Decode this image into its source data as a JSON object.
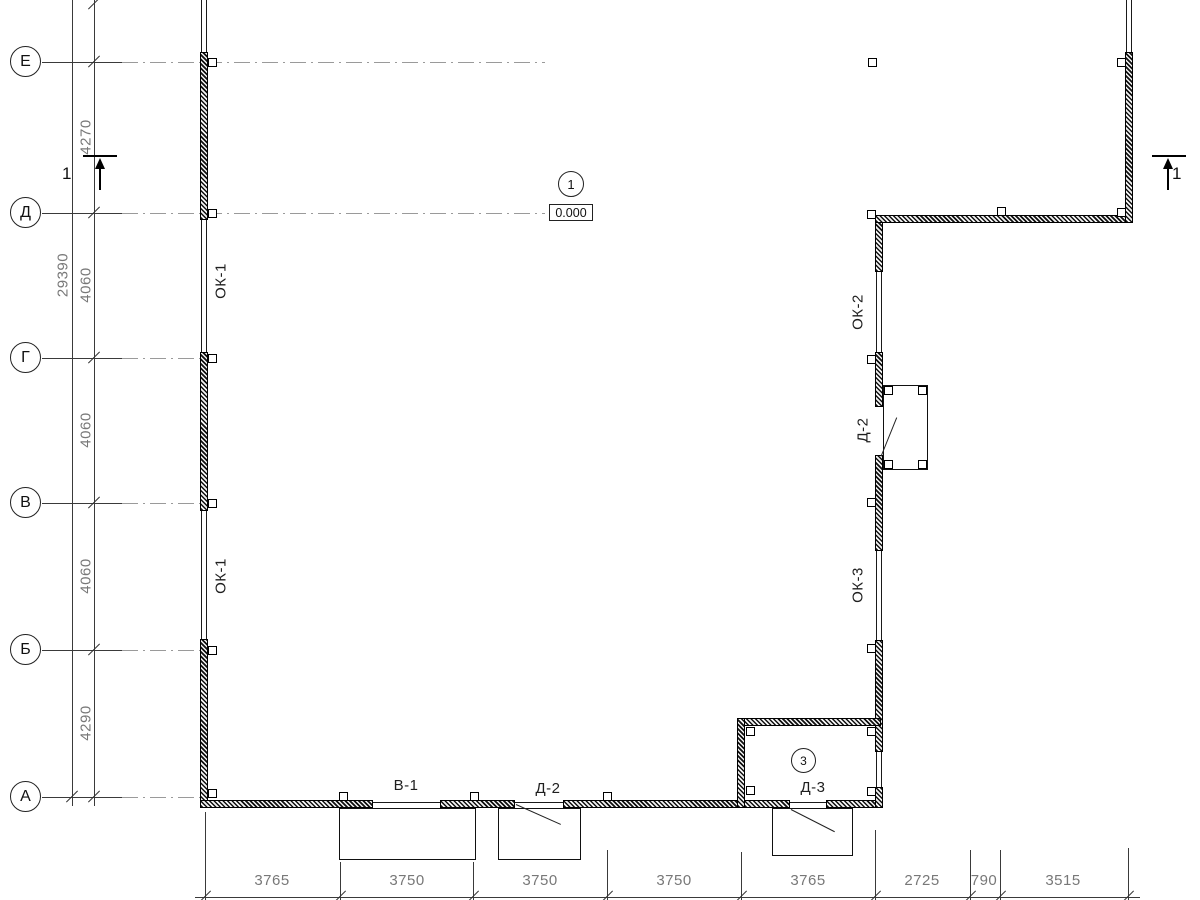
{
  "axes": {
    "labels": [
      "Е",
      "Д",
      "Г",
      "В",
      "Б",
      "А"
    ]
  },
  "dims_left": {
    "total": "29390",
    "segments": [
      "4270",
      "4060",
      "4060",
      "4060",
      "4290"
    ]
  },
  "dims_bottom": {
    "values": [
      "3765",
      "3750",
      "3750",
      "3750",
      "3765",
      "2725",
      "790",
      "3515"
    ]
  },
  "labels": {
    "ok1_a": "ОК-1",
    "ok1_b": "ОК-1",
    "ok2": "ОК-2",
    "ok3": "ОК-3",
    "d2_right": "Д-2",
    "v1": "В-1",
    "d2_bottom": "Д-2",
    "d3": "Д-3"
  },
  "markers": {
    "plan_marker": "1",
    "elevation": "0.000",
    "room_marker": "3",
    "section_left": "1",
    "section_right": "1"
  },
  "colors": {
    "line": "#3a3a3a",
    "wall": "#000000",
    "dim_text": "#787878",
    "axis_gray": "#9a9a9a"
  }
}
